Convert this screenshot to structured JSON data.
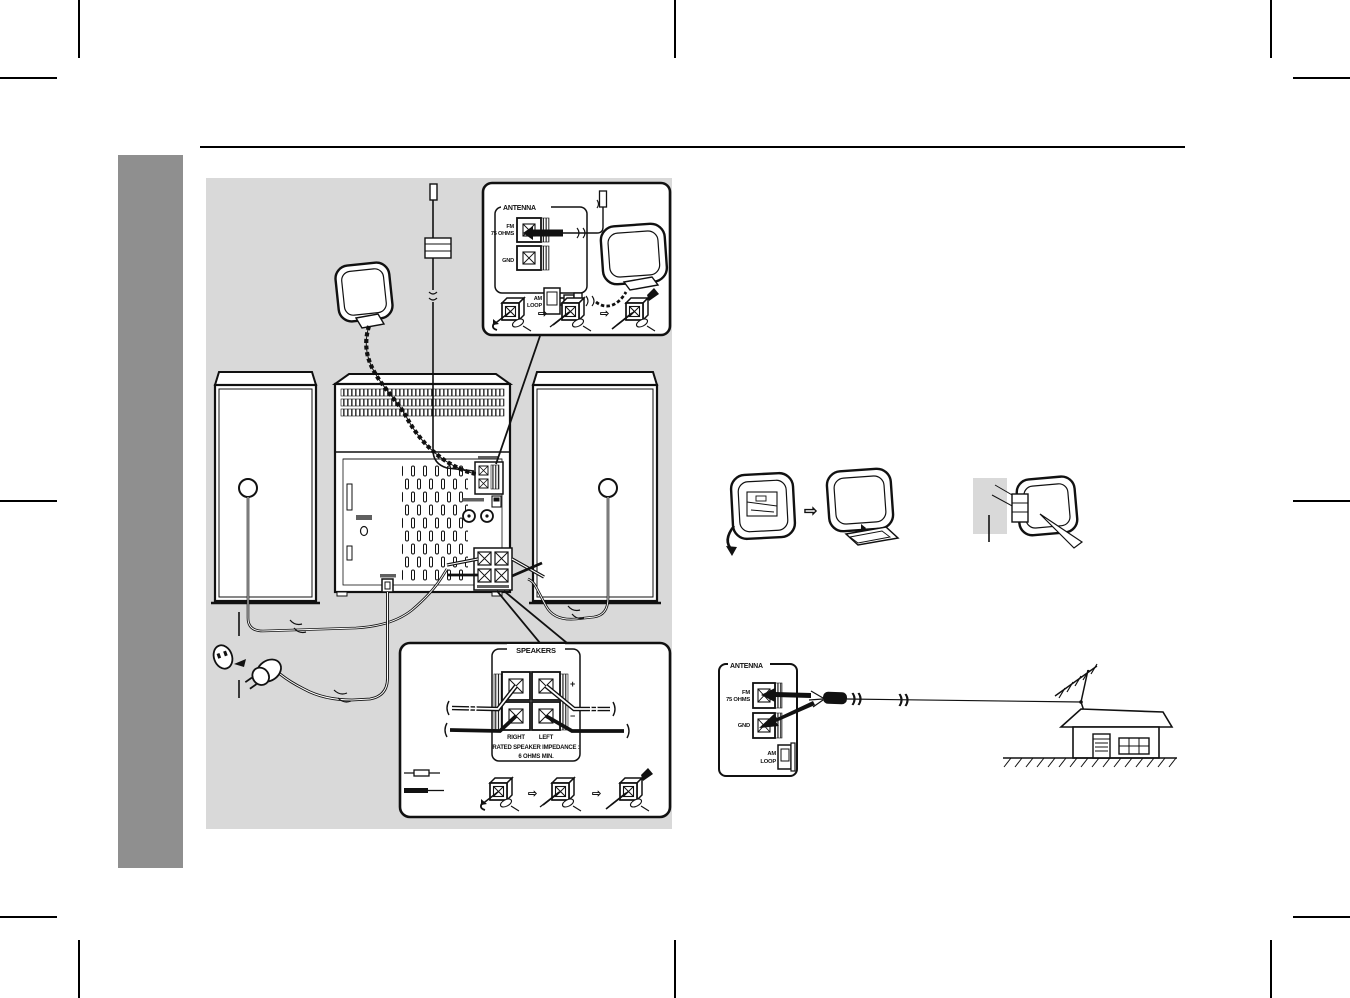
{
  "page": {
    "bg": "#ffffff",
    "line_color": "#111111",
    "sidebar_color": "#8f8f8f",
    "diagram_bg": "#d9d9d9"
  },
  "antenna_inset": {
    "title": "ANTENNA",
    "fm": "FM",
    "fm_ohms": "75 OHMS",
    "gnd": "GND",
    "am": "AM",
    "am_loop": "LOOP"
  },
  "speakers_inset": {
    "title": "SPEAKERS",
    "plus": "+",
    "minus": "−",
    "right": "RIGHT",
    "left": "LEFT",
    "impedance1": "RATED SPEAKER IMPEDANCE :",
    "impedance2": "6 OHMS MIN."
  },
  "outdoor_antenna": {
    "title": "ANTENNA",
    "fm": "FM",
    "fm_ohms": "75 OHMS",
    "gnd": "GND",
    "am": "AM",
    "am_loop": "LOOP"
  },
  "icons": {
    "step_arrow": "⇨",
    "assembly_arrow": "⇨"
  }
}
